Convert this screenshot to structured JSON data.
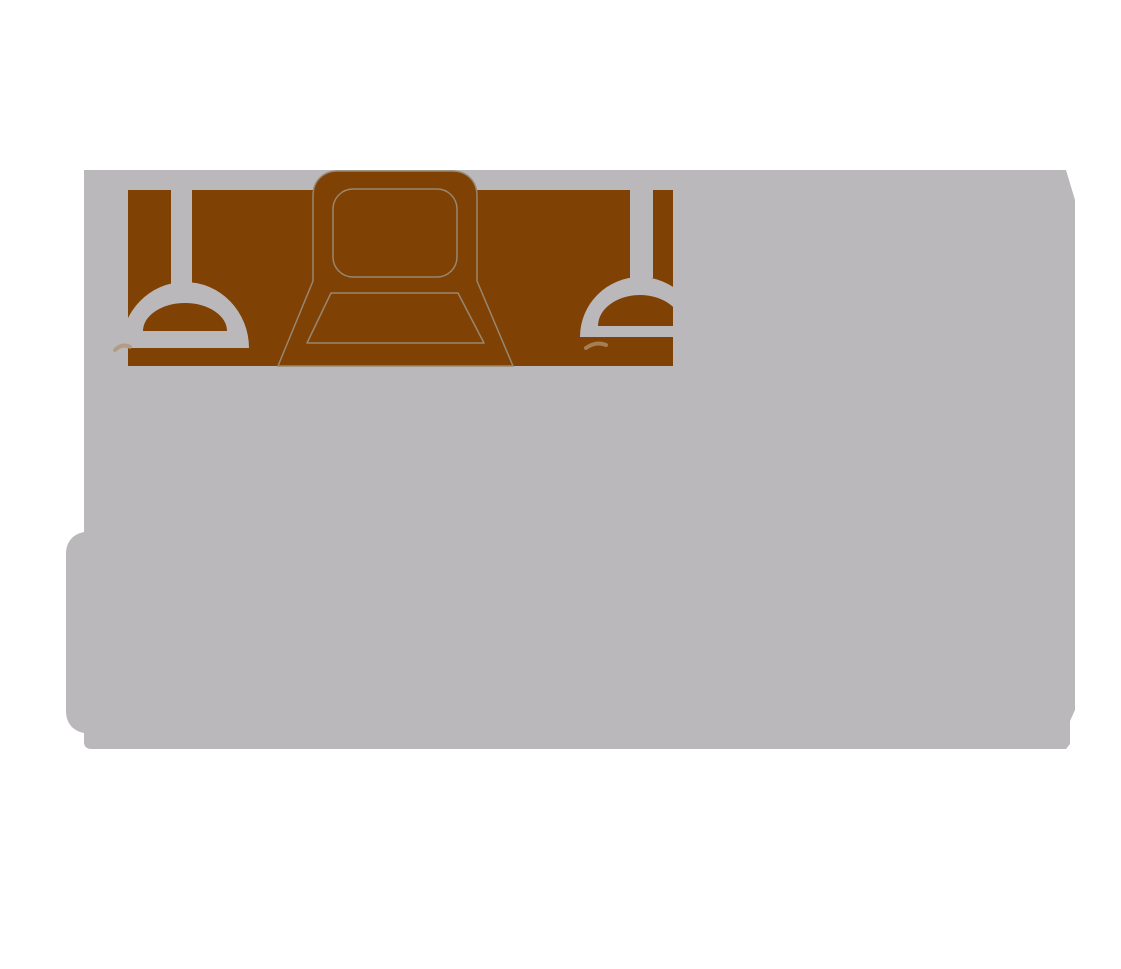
{
  "scene": {
    "background_color": "#ffffff",
    "description": "Abstract two-tone illustration: large gray backdrop panel, brown wall band, two hanging pendant lamps, armchair silhouette with thin tan outlines"
  },
  "colors": {
    "background": "#ffffff",
    "panel_gray": "#bab8ba",
    "band_brown": "#7f4104",
    "outline_tan": "#98876f",
    "smudge_tan": "#b2936f",
    "none": "none"
  }
}
